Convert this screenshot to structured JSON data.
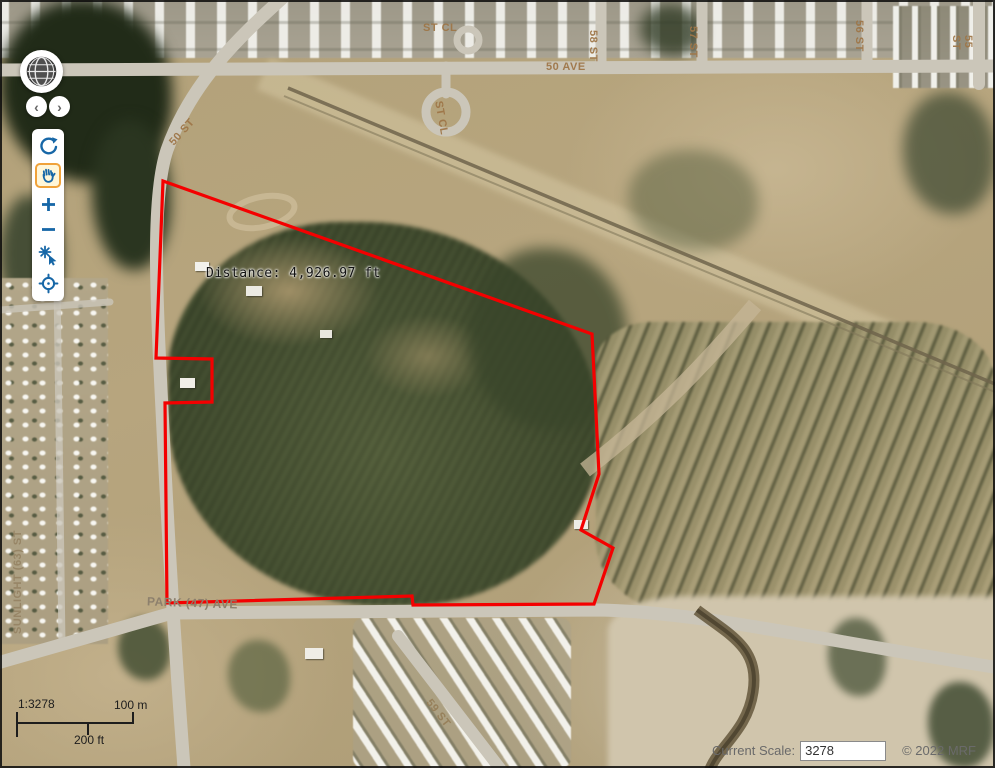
{
  "app": {
    "kind": "web-gis-aerial-viewer",
    "frame_color": "#000000"
  },
  "colors": {
    "polygon_red": "#f40000",
    "icon_blue": "#1767a7",
    "active_tool_orange": "#f0a23a",
    "road_gray": "#cbc6b9",
    "field_tan": "#b3a078",
    "forest_green": "#3e492d",
    "label_tan": "#9e7849",
    "status_gray": "#6a6a6a"
  },
  "toolbar": {
    "globe_icon": "globe-overview-icon",
    "prev_glyph": "‹",
    "next_glyph": "›",
    "tools": [
      {
        "name": "refresh",
        "icon": "refresh-icon",
        "active": false
      },
      {
        "name": "pan",
        "icon": "pan-hand-icon",
        "active": true
      },
      {
        "name": "zoom-in",
        "icon": "plus-icon",
        "active": false
      },
      {
        "name": "zoom-out",
        "icon": "minus-icon",
        "active": false
      },
      {
        "name": "zoom-to-point",
        "icon": "zoom-click-icon",
        "active": false
      },
      {
        "name": "center-crosshair",
        "icon": "crosshair-icon",
        "active": false
      }
    ]
  },
  "map": {
    "distance_label": "Distance: 4,926.97 ft",
    "street_labels": [
      {
        "text": "ST CL"
      },
      {
        "text": "50 AVE"
      },
      {
        "text": "58 ST"
      },
      {
        "text": "57 ST"
      },
      {
        "text": "56 ST"
      },
      {
        "text": "55 ST"
      },
      {
        "text": "50 ST"
      },
      {
        "text": "ST CL"
      },
      {
        "text": "SUNLIGHT (63) ST"
      },
      {
        "text": "PARK (47) AVE"
      },
      {
        "text": "59 ST"
      }
    ]
  },
  "scalebar": {
    "ratio_text": "1:3278",
    "metric_text": "100 m",
    "imperial_text": "200 ft"
  },
  "statusbar": {
    "scale_label": "Current Scale:",
    "scale_value": "3278",
    "copyright": "© 2022 MRF"
  }
}
